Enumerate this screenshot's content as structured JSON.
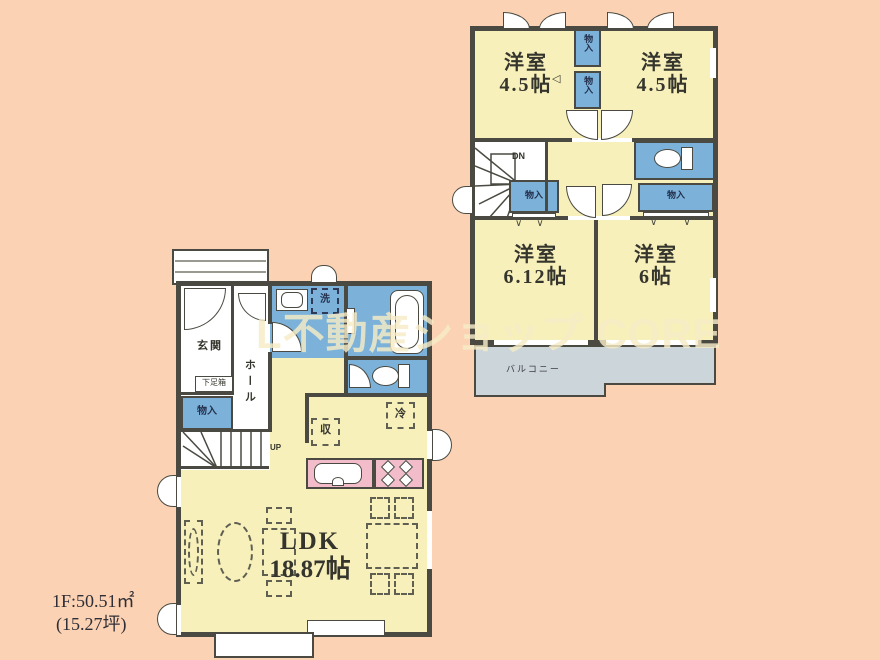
{
  "watermark": {
    "text": "L不動産ショップ CORE"
  },
  "area_note": {
    "line1": "1F:50.51㎡",
    "line2": "(15.27坪)"
  },
  "colors": {
    "background": "#fcd2b4",
    "room_fill": "#f7f0ba",
    "wet_area_fill": "#7cb2d9",
    "kitchen_fill": "#f2bccb",
    "balcony_fill": "#ccd5da",
    "wall": "#4a4a42",
    "watermark": "#f5ecc6"
  },
  "floor2": {
    "room_top_left": {
      "name": "洋室",
      "size": "4.5帖"
    },
    "room_top_right": {
      "name": "洋室",
      "size": "4.5帖"
    },
    "room_bottom_left": {
      "name": "洋室",
      "size": "6.12帖"
    },
    "room_bottom_right": {
      "name": "洋室",
      "size": "6帖"
    },
    "closet_a": "物入",
    "closet_b": "物入",
    "closet_mid": "物入",
    "closet_right": "物入",
    "stairs_label": "DN",
    "balcony_label": "バルコニー"
  },
  "floor1": {
    "entrance": "玄関",
    "shoe_box": "下足箱",
    "closet": "物入",
    "hall": "ホール",
    "stairs_label": "UP",
    "laundry": "洗",
    "storage": "収",
    "fridge": "冷",
    "ldk_name": "LDK",
    "ldk_size": "18.87帖"
  }
}
